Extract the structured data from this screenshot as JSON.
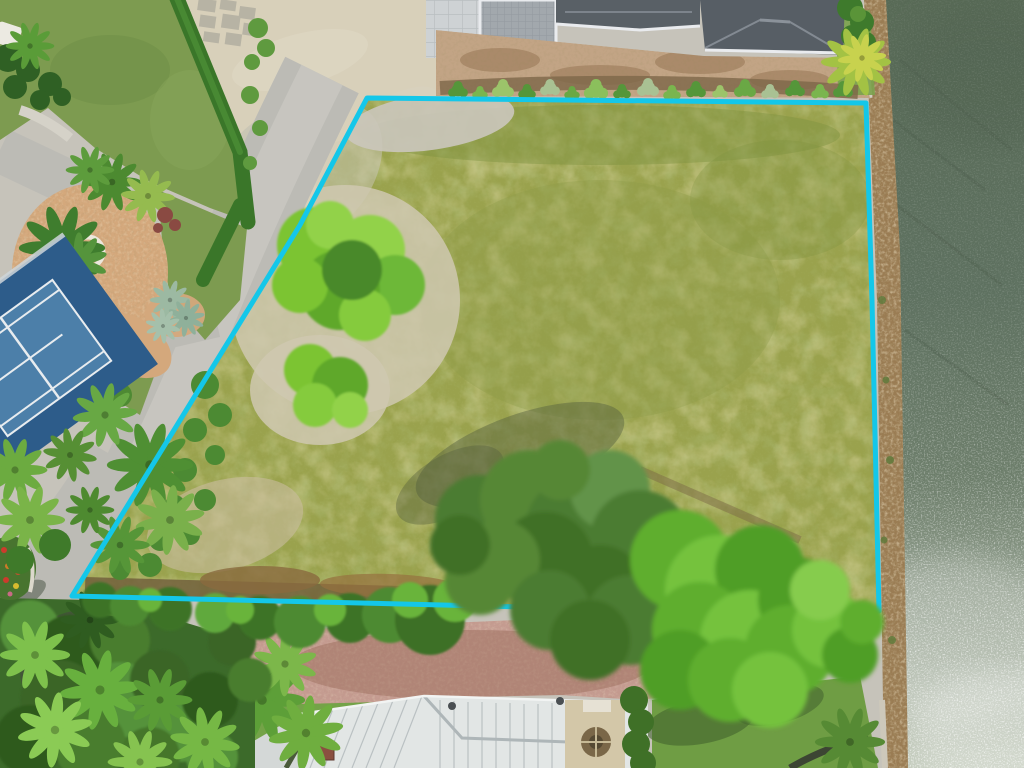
{
  "image": {
    "kind": "aerial-drone-photo",
    "subject": "vacant waterfront residential lot outlined with a cyan property-boundary overlay",
    "width": 1024,
    "height": 768
  },
  "boundary": {
    "color": "#14c7e9",
    "stroke_width": 5,
    "vertices": [
      [
        367,
        98
      ],
      [
        866,
        103
      ],
      [
        872,
        300
      ],
      [
        879,
        611
      ],
      [
        851,
        615
      ],
      [
        72,
        596
      ],
      [
        300,
        225
      ]
    ]
  },
  "colors": {
    "boundary": "#14c7e9",
    "base_ground": "#c6c3ba",
    "water_top": "#586a56",
    "water_mid": "#6d7e6b",
    "water_low": "#9aa695",
    "water_bright": "#c4ccbd",
    "rock": "#9a7c53",
    "rock_cap": "#d3cec2",
    "lot_grass": "#9aa24d",
    "lawn": "#7d9b50",
    "hedge": "#3a7629",
    "sand": "#cbc7bc",
    "sand_warm": "#d8d0ba",
    "road": "#bcbbb5",
    "mulch": "#d4a87c",
    "ring_white": "#ece7dc",
    "court_outer": "#2d5c8a",
    "court_inner": "#4c7fa9",
    "court_line": "#e8ecef",
    "roof_dark": "#596066",
    "roof_trim": "#e9ebee",
    "screen": "#a2a8ad",
    "paver_pad": "#ced2d4",
    "dirt": "#c2a485",
    "dirt_dark": "#7d6648",
    "brick": "#c59c91",
    "roof_white": "#e2e6e5",
    "roof_seam": "#b3babd",
    "stair_tan": "#d3c7a8",
    "gravel": "#cfc4ab",
    "lawn_oval": "#74a348",
    "neighbor_lawn": "#6f9d44",
    "tree_dark": "#3f7027",
    "tree_mid": "#568a34",
    "tree_bright": "#6fba3a",
    "tree_chartreuse": "#85cb3c",
    "shadow_green": "#45523a"
  },
  "regions": [
    {
      "name": "water",
      "desc": "intracoastal waterway along right edge, sun glitter toward bottom"
    },
    {
      "name": "riprap-seawall",
      "desc": "rock revetment between lot and water"
    },
    {
      "name": "vacant-lot",
      "desc": "large mowed yellow-green grass parcel inside cyan boundary"
    },
    {
      "name": "boundary-overlay",
      "desc": "cyan surveyed property line"
    },
    {
      "name": "top-house",
      "desc": "gray shingle hip roof home with screened patio, north of lot"
    },
    {
      "name": "bottom-house",
      "desc": "white metal hip roof home with brick paver drive, south of lot"
    },
    {
      "name": "tennis-court",
      "desc": "blue tennis court on neighboring parcel, west"
    },
    {
      "name": "circular-drive",
      "desc": "mulch roundabout island with center palm"
    },
    {
      "name": "street",
      "desc": "gray residential road running diagonally along west boundary"
    },
    {
      "name": "tree-cluster",
      "desc": "large green canopy group near south boundary"
    }
  ]
}
